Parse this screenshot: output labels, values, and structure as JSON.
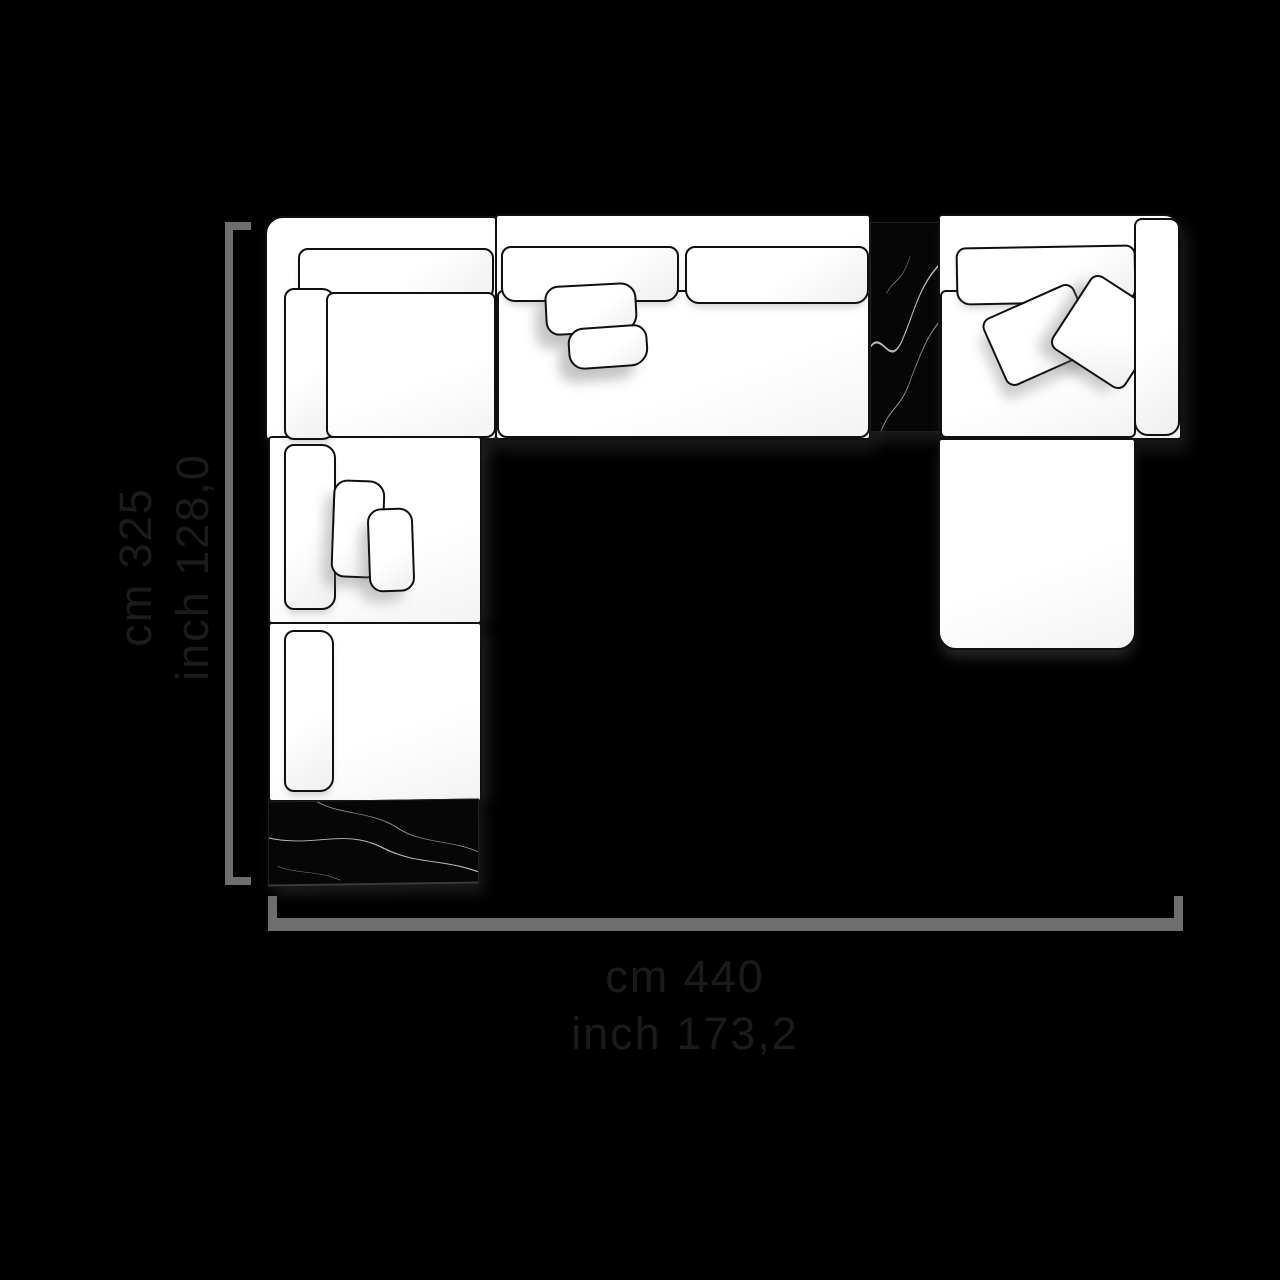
{
  "dimensions": {
    "width": {
      "cm_text": "cm 440",
      "inch_text": "inch 173,2"
    },
    "height": {
      "cm_text": "cm 325",
      "inch_text": "inch 128,0"
    }
  },
  "colors": {
    "background": "#000000",
    "dimension_line": "#6e6e6e",
    "label_text": "#1b1b1b",
    "sofa_fill": "#ffffff",
    "sofa_outline": "#101010",
    "marble_fill": "#060606",
    "marble_vein": "#d8d8d8",
    "shadow": "#8c8c8c"
  }
}
